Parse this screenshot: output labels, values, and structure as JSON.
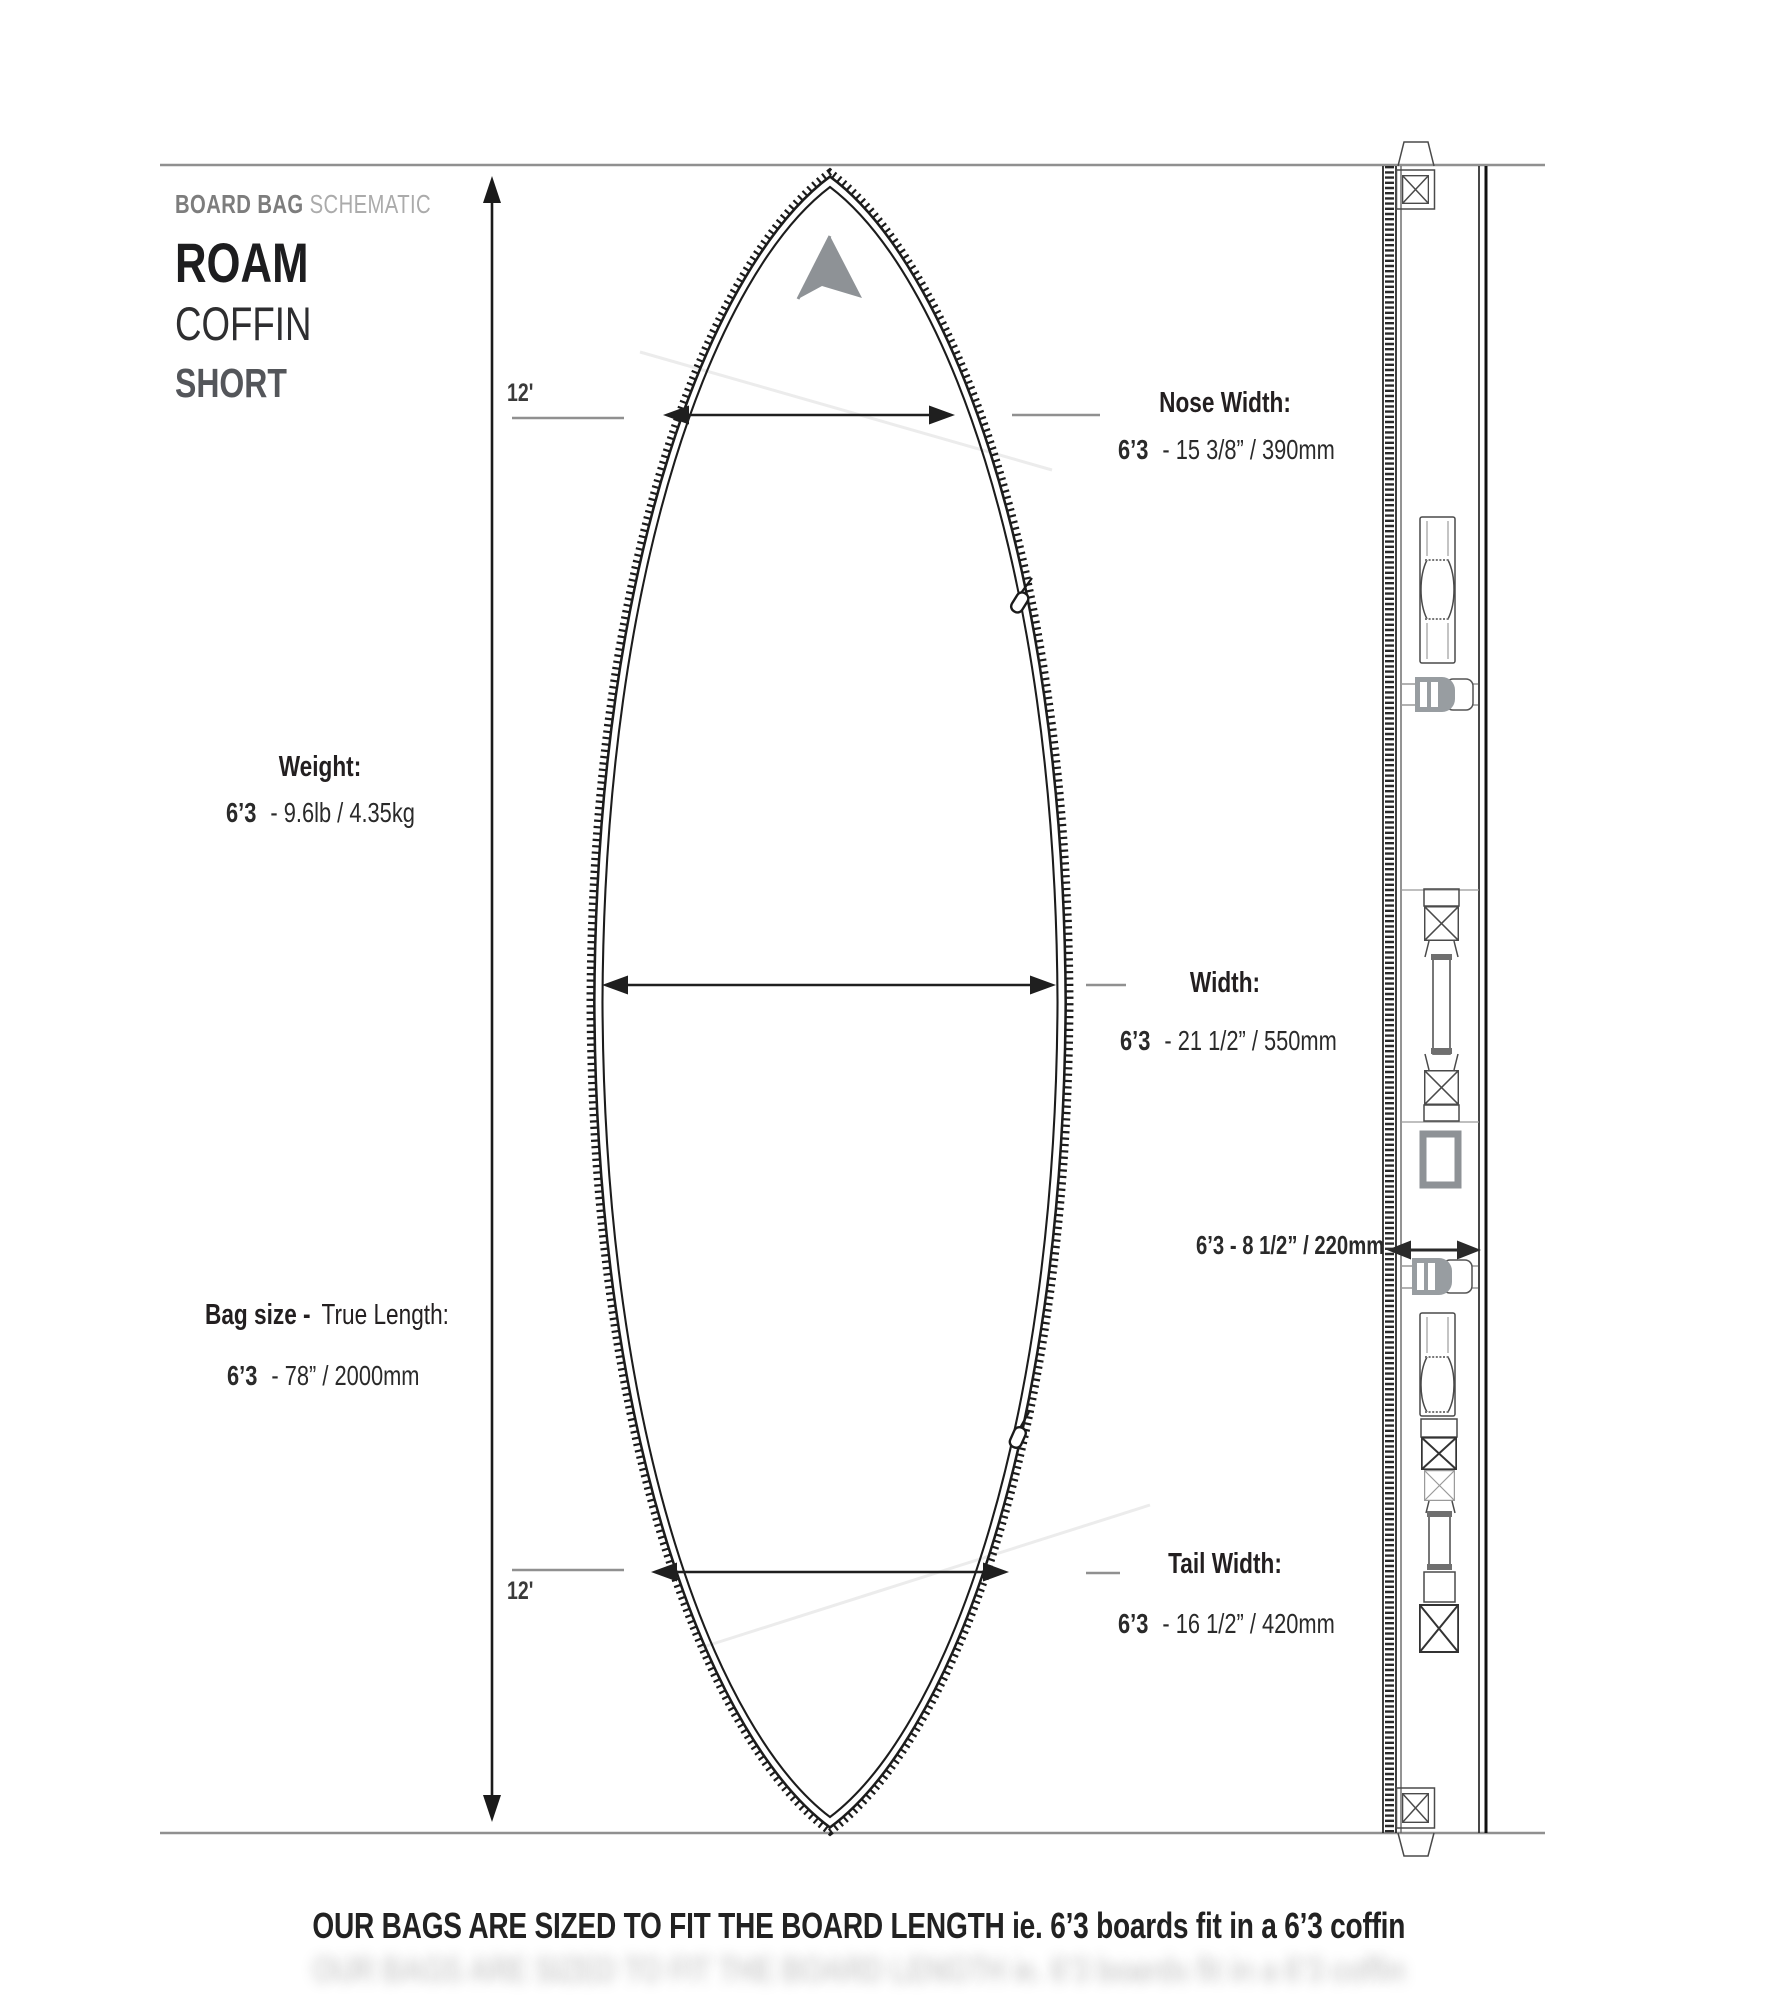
{
  "header": {
    "category_primary": "BOARD BAG",
    "category_secondary": "SCHEMATIC",
    "brand": "ROAM",
    "line": "COFFIN",
    "variant": "SHORT"
  },
  "board": {
    "length_markers": {
      "nose": "12'",
      "tail": "12'"
    },
    "measurements": {
      "nose_width": {
        "label": "Nose Width:",
        "size": "6’3",
        "value": "- 15 3/8” / 390mm"
      },
      "weight": {
        "label": "Weight:",
        "size": "6’3",
        "value": "- 9.6lb / 4.35kg"
      },
      "width": {
        "label": "Width:",
        "size": "6’3",
        "value": "- 21 1/2” / 550mm"
      },
      "bag_size": {
        "label_primary": "Bag size -",
        "label_secondary": "True Length:",
        "size": "6’3",
        "value": "- 78” / 2000mm"
      },
      "depth": {
        "value": "6’3 - 8 1/2” / 220mm"
      },
      "tail_width": {
        "label": "Tail Width:",
        "size": "6’3",
        "value": "- 16 1/2” / 420mm"
      }
    }
  },
  "footer": {
    "note": "OUR BAGS ARE SIZED TO FIT THE BOARD LENGTH ie. 6’3 boards fit in a 6’3 coffin"
  },
  "colors": {
    "ink": "#231f20",
    "muted_gray": "#7d7d7d",
    "light_gray": "#ababab",
    "line_gray": "#909090",
    "logo_gray": "#8e9296"
  }
}
